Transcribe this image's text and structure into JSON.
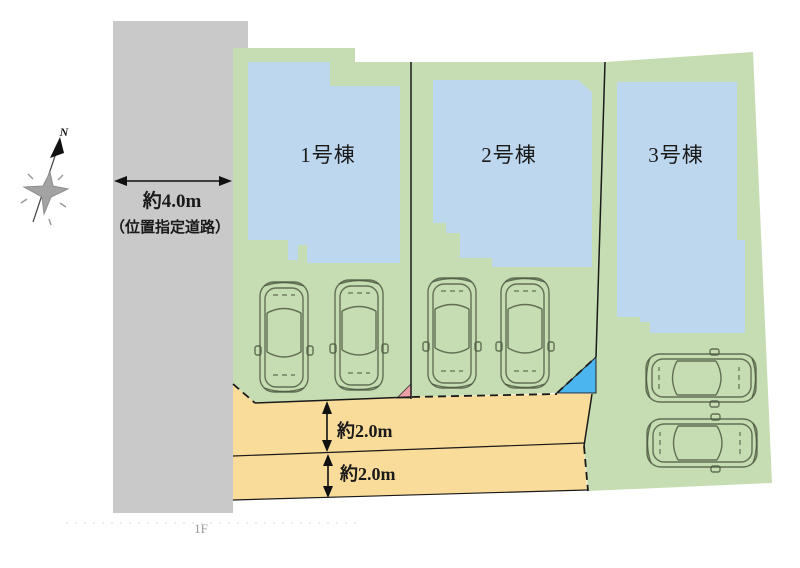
{
  "plan": {
    "title_note": "site layout plan",
    "road": {
      "width_label": "約4.0m",
      "type_label": "（位置指定道路）"
    },
    "buildings": [
      {
        "label": "1号棟"
      },
      {
        "label": "2号棟"
      },
      {
        "label": "3号棟"
      }
    ],
    "dimensions": [
      {
        "label": "約2.0m"
      },
      {
        "label": "約2.0m"
      }
    ],
    "compass": {
      "label": "N"
    },
    "floor_label": "1F",
    "parking": {
      "car_count": 6
    }
  },
  "colors": {
    "road": "#c9c9c9",
    "lot": "#c6dcb2",
    "building": "#bdd7ee",
    "alley": "#fadc9a",
    "pink": "#ee9fa8",
    "skyblue": "#4ab5ee",
    "line": "#1a1a1a",
    "text": "#1a1a1a"
  }
}
